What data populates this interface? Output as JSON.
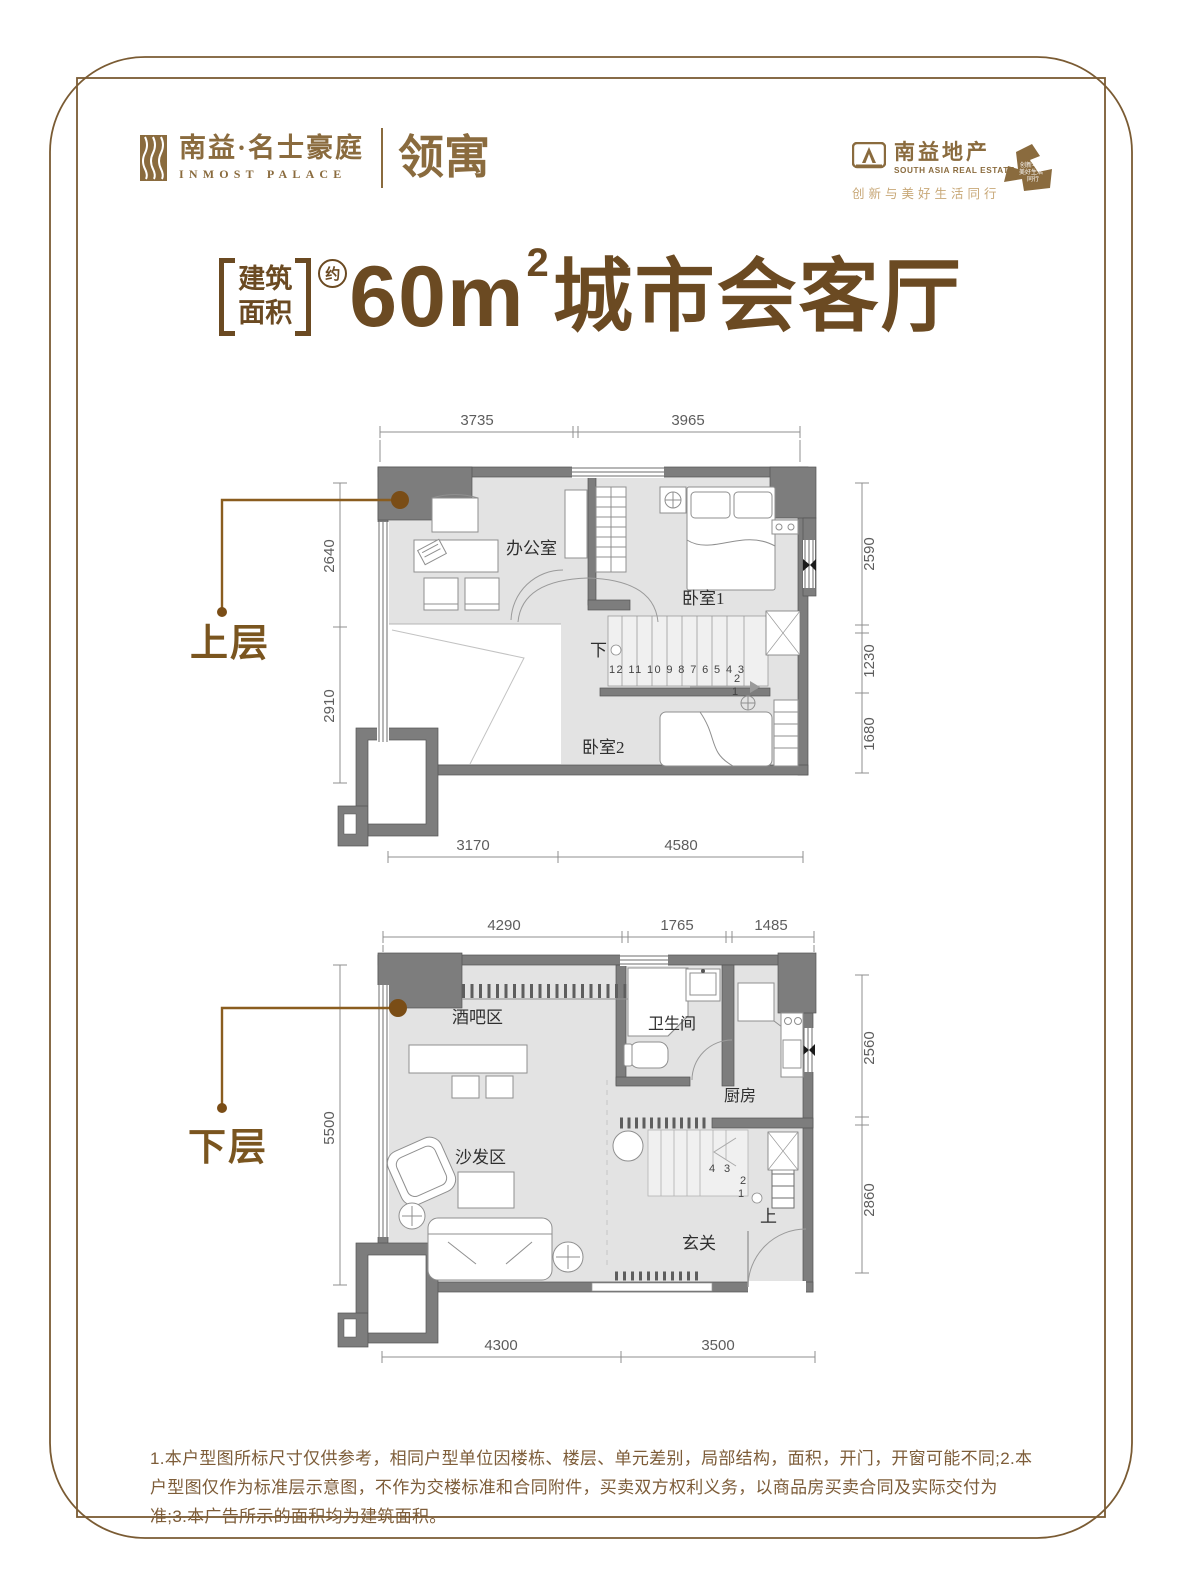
{
  "brand": {
    "left": {
      "name_cn": "南益·名士豪庭",
      "name_en": "INMOST PALACE",
      "product": "领寓"
    },
    "right": {
      "name_cn": "南益地产",
      "name_en": "SOUTH ASIA REAL ESTATE",
      "tagline": "创新与美好生活同行",
      "seal_line1": "创新与",
      "seal_line2": "美好生活",
      "seal_line3": "同行"
    }
  },
  "title": {
    "bracket_line1": "建筑",
    "bracket_line2": "面积",
    "approx": "约",
    "area_value": "60m",
    "area_sup": "2",
    "headline": "城市会客厅"
  },
  "plans": {
    "upper": {
      "label": "上层",
      "rooms": {
        "office": "办公室",
        "bedroom1": "卧室1",
        "bedroom2": "卧室2"
      },
      "stairs": {
        "direction": "下",
        "run": "12 11 10 9 8 7 6 5 4 3",
        "step2": "2",
        "step1": "1"
      },
      "dims": {
        "top": [
          "3735",
          "3965"
        ],
        "left": [
          "2640",
          "2910"
        ],
        "right": [
          "2590",
          "1230",
          "1680"
        ],
        "bottom": [
          "3170",
          "4580"
        ]
      }
    },
    "lower": {
      "label": "下层",
      "rooms": {
        "bar": "酒吧区",
        "bathroom": "卫生间",
        "kitchen": "厨房",
        "sofa": "沙发区",
        "foyer": "玄关"
      },
      "stairs": {
        "direction": "上",
        "step4": "4",
        "step3": "3",
        "step2": "2",
        "step1": "1"
      },
      "dims": {
        "top": [
          "4290",
          "1765",
          "1485"
        ],
        "left": [
          "5500"
        ],
        "right": [
          "2560",
          "2860"
        ],
        "bottom": [
          "4300",
          "3500"
        ]
      }
    }
  },
  "disclaimer": "1.本户型图所标尺寸仅供参考，相同户型单位因楼栋、楼层、单元差别，局部结构，面积，开门，开窗可能不同;2.本户型图仅作为标准层示意图，不作为交楼标准和合同附件，买卖双方权利义务，以商品房买卖合同及实际交付为准;3.本广告所示的面积均为建筑面积。",
  "colors": {
    "brand": "#8a6b3e",
    "title": "#6b4a22",
    "tagline": "#c8a878",
    "callout": "#7a4d16",
    "wall": "#7d7d7d",
    "floor": "#e3e3e3",
    "dim_text": "#5d5d5d",
    "frame": "#7a5b33"
  }
}
